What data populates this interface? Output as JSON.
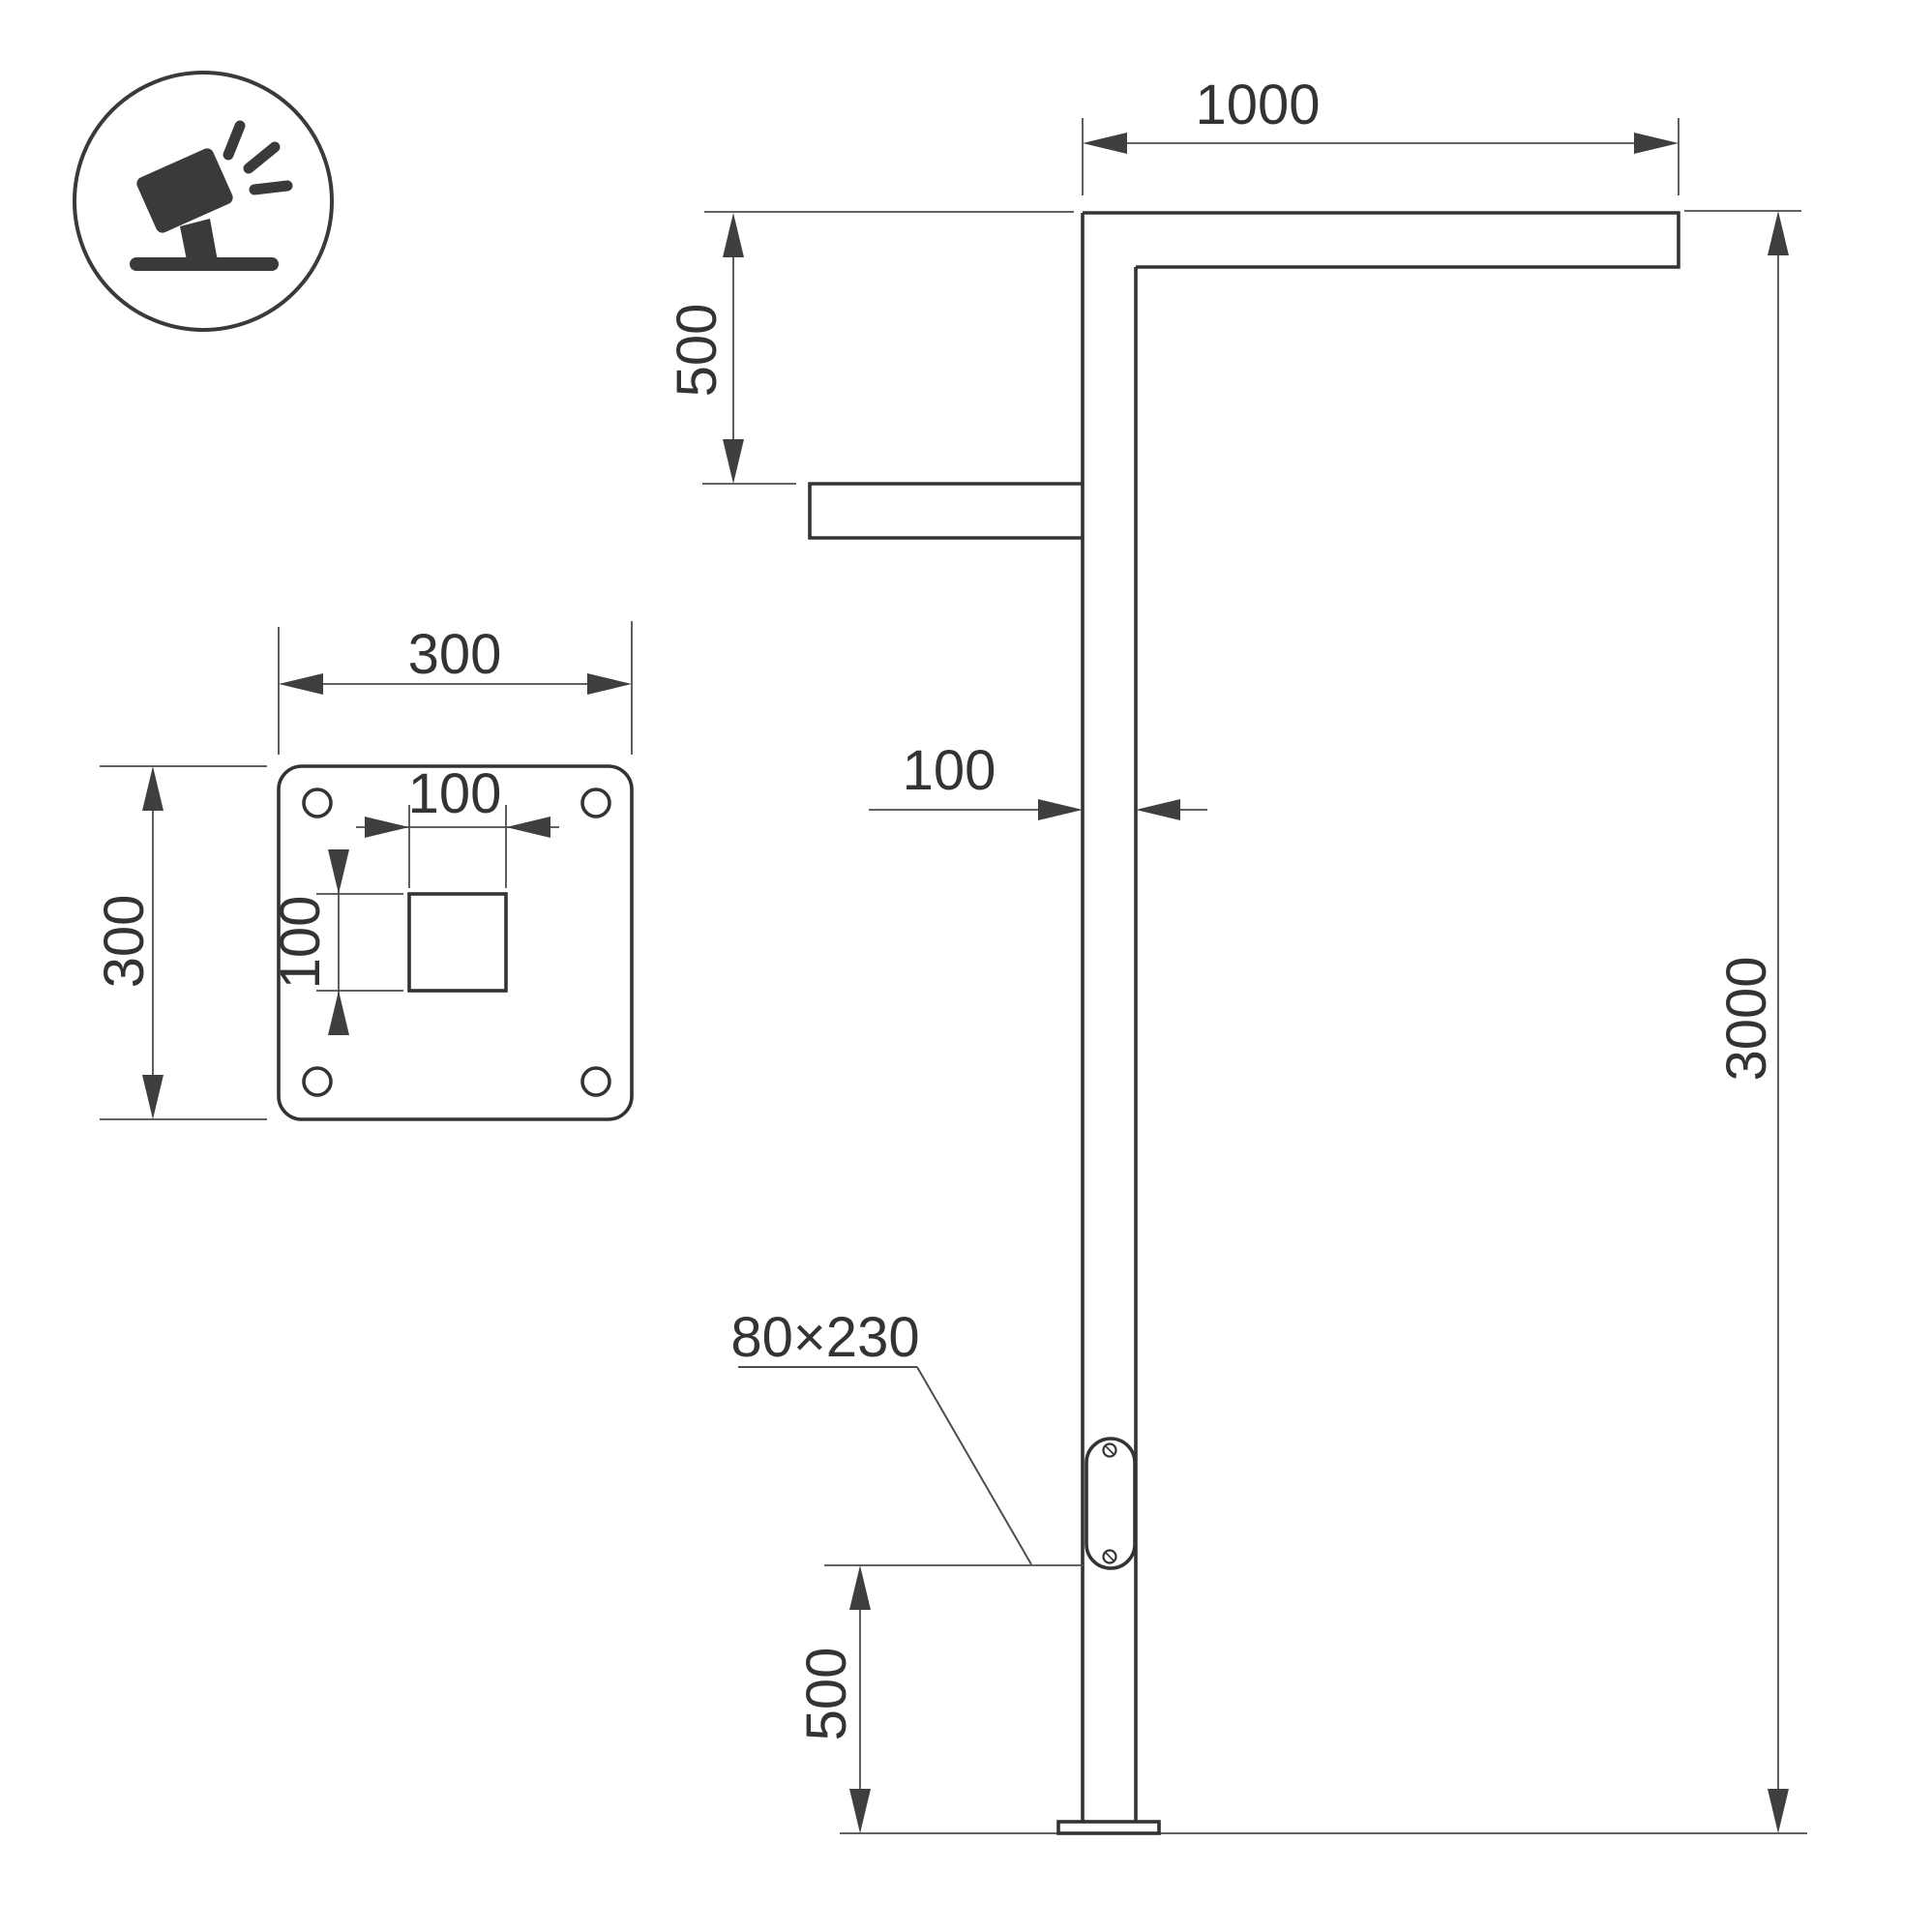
{
  "colors": {
    "background": "#ffffff",
    "outline": "#333333",
    "dimension_lines": "#4d4d4d",
    "arrowheads": "#3f3f3f",
    "icon": "#3a3a3a"
  },
  "icon": {
    "type": "tilted-floodlight-on-stand"
  },
  "plate_view": {
    "dim_width": "300",
    "dim_height": "300",
    "dim_cutout_width": "100",
    "dim_cutout_height": "100"
  },
  "elevation_view": {
    "dim_arm_length": "1000",
    "dim_arm_drop": "500",
    "dim_pole_width": "100",
    "dim_total_height": "3000",
    "dim_service_panel_height": "500",
    "service_panel_label": "80×230"
  }
}
